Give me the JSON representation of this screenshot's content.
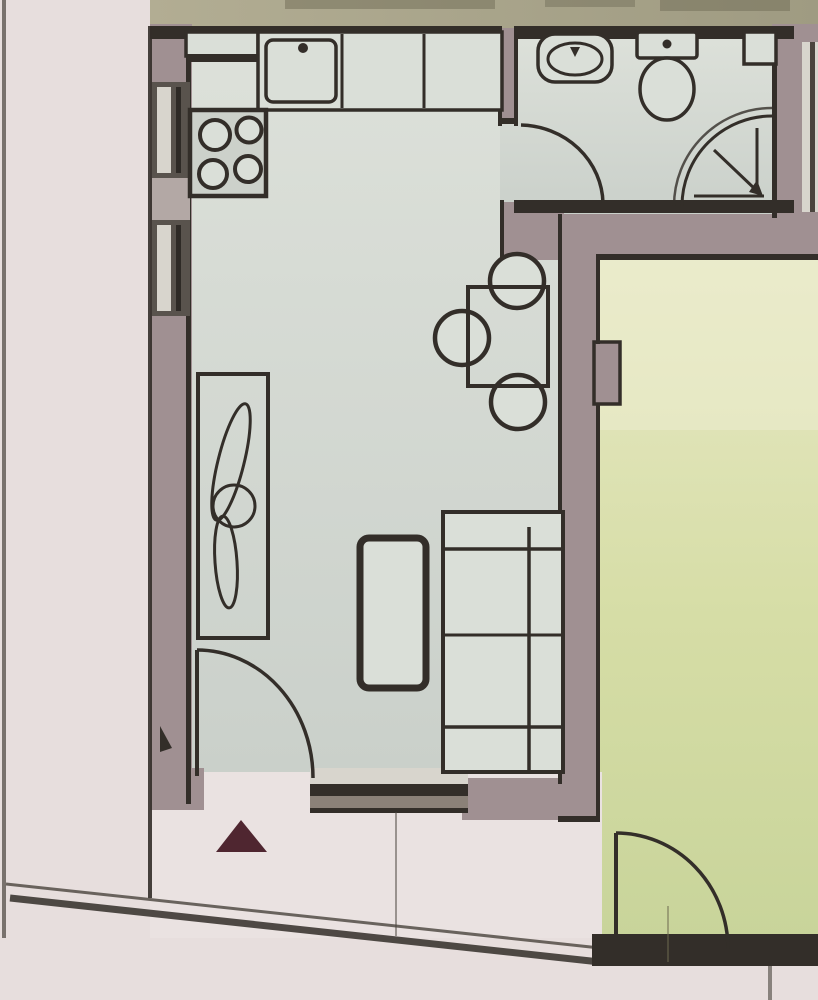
{
  "document": {
    "kind": "floor-plan",
    "description": "Photographed architectural floor plan of a small apartment, no text labels visible"
  },
  "rooms": [
    {
      "id": "kitchen-living-room",
      "floor_color": "#d5dad2",
      "contents": [
        "kitchen-counter",
        "stove",
        "kitchen-sink",
        "dining-table",
        "three-chairs",
        "cabinet-with-plant",
        "sofa",
        "coffee-table"
      ]
    },
    {
      "id": "bathroom",
      "floor_color": "#d8dcd6",
      "contents": [
        "wash-basin",
        "toilet",
        "corner-shower",
        "duct-block"
      ]
    },
    {
      "id": "bedroom",
      "floor_color": "#dfe3b0",
      "contents": [
        "door-swing"
      ]
    },
    {
      "id": "entry-corridor",
      "floor_color": "#e9e1e0",
      "contents": [
        "direction-triangle",
        "steps"
      ]
    },
    {
      "id": "outside-left-strip",
      "floor_color": "#e7dfdf",
      "contents": []
    }
  ],
  "fixtures": [
    "kitchen-corner-cabinet",
    "kitchen-counter-run",
    "kitchen-sink-dot-faucet",
    "stove-four-burners",
    "bathroom-basin-oval",
    "toilet-with-tank",
    "corner-shower-quarter-circle-with-arrow",
    "dining-table-rect",
    "round-chair-top",
    "round-chair-left",
    "round-chair-bottom",
    "wall-cabinet-with-plant",
    "sofa-with-backrest",
    "coffee-table-rounded",
    "entrance-door-swing",
    "bathroom-door-swing",
    "bedroom-door-swing",
    "left-wall-window-upper",
    "left-wall-window-lower",
    "bottom-wall-window-band",
    "north-or-entry-triangle-marker",
    "wall-notch-pilaster"
  ],
  "colors": {
    "paper": "#e7dedd",
    "oliveA": "#b2ad93",
    "oliveB": "#9f9b82",
    "oliveSmudge": "#6f6b56",
    "wall": "#a09092",
    "wallLight": "#b3a8a5",
    "ink": "#332e29",
    "inkSoft": "#4a443d",
    "floorA": "#dde1da",
    "floorB": "#cad0ca",
    "bedA": "#e9eac8",
    "bedB": "#d6dda6",
    "bedC": "#c8d49a",
    "corridor": "#eae2e1",
    "furniture": "#dadfd8",
    "stove": "#ccd1ca",
    "window": "#59534d",
    "pane": "#d8d5cd",
    "maroon": "#4f2630",
    "glassBand": "#8b8178"
  }
}
